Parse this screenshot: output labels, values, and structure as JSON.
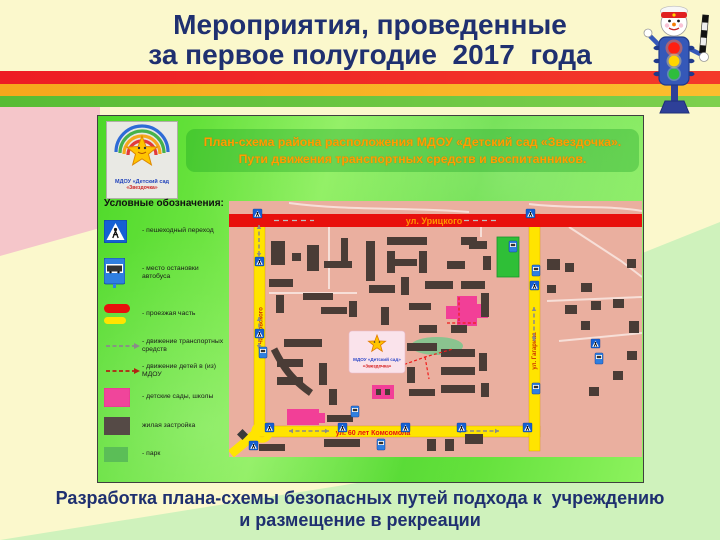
{
  "page": {
    "title": {
      "line1": "Мероприятия, проведенные",
      "line2": "за первое полугодие  2017  года"
    },
    "caption": {
      "line1": "Разработка плана-схемы безопасных путей подхода к  учреждению",
      "line2": "и размещение в рекреации"
    }
  },
  "figure": {
    "logo": {
      "line1": "МДОУ «Детский сад",
      "line2": "«Звездочка»"
    },
    "banner": {
      "line1": "План-схема района расположения МДОУ «Детский сад «Звездочка».",
      "line2": "Пути движения транспортных средств и воспитанников."
    },
    "legend": {
      "title": "Условные обозначения:",
      "items": [
        {
          "name": "crosswalk-sign",
          "label": "- пешеходный переход"
        },
        {
          "name": "bus-stop-sign",
          "label": "- место остановки автобуса"
        },
        {
          "name": "roadway",
          "label": "- проезжая часть"
        },
        {
          "name": "vehicle-traffic",
          "label": "- движение транспортных средств"
        },
        {
          "name": "children-route",
          "label": "- движение детей в (из) МДОУ"
        },
        {
          "name": "kindergartens-schools",
          "label": "- детские сады, школы"
        },
        {
          "name": "residential",
          "label": "жилая застройка"
        },
        {
          "name": "park",
          "label": "- парк"
        }
      ]
    },
    "map": {
      "street_top": "ул. Урицкого",
      "street_bottom": "ул. 60 лет Комсомола",
      "street_left": "ул. Чайковского",
      "street_right": "ул. Гагарина",
      "marker_line1": "МДОУ «Детский сад»",
      "marker_line2": "«Звездочка»",
      "colors": {
        "ground": "#EAAF9F",
        "building": "#4A3C36",
        "street_yellow": "#FFE400",
        "street_red": "#E8100C",
        "pink": "#F23F97",
        "green_zone": "#2FBF37",
        "lawn": "#8AC38F",
        "label_red": "#E81010",
        "label_orange": "#FF9500",
        "path_red": "#F01B1B",
        "arrow_gray": "#8A8A8A"
      },
      "buildings": [
        [
          42,
          40,
          14,
          24
        ],
        [
          63,
          52,
          9,
          8
        ],
        [
          78,
          44,
          12,
          26
        ],
        [
          95,
          60,
          28,
          7
        ],
        [
          112,
          37,
          7,
          26
        ],
        [
          40,
          78,
          24,
          8
        ],
        [
          47,
          94,
          8,
          18
        ],
        [
          74,
          92,
          30,
          7
        ],
        [
          92,
          106,
          26,
          7
        ],
        [
          120,
          100,
          8,
          16
        ],
        [
          137,
          40,
          9,
          40
        ],
        [
          158,
          36,
          40,
          8
        ],
        [
          158,
          50,
          8,
          22
        ],
        [
          190,
          50,
          8,
          22
        ],
        [
          164,
          58,
          24,
          7
        ],
        [
          140,
          84,
          26,
          8
        ],
        [
          172,
          76,
          8,
          18
        ],
        [
          152,
          106,
          8,
          18
        ],
        [
          180,
          102,
          22,
          7
        ],
        [
          196,
          80,
          28,
          8
        ],
        [
          232,
          80,
          24,
          8
        ],
        [
          218,
          60,
          18,
          8
        ],
        [
          240,
          40,
          18,
          8
        ],
        [
          254,
          55,
          8,
          14
        ],
        [
          232,
          36,
          16,
          8
        ],
        [
          252,
          92,
          8,
          24
        ],
        [
          318,
          58,
          13,
          11
        ],
        [
          336,
          62,
          9,
          9
        ],
        [
          352,
          82,
          11,
          9
        ],
        [
          318,
          84,
          9,
          8
        ],
        [
          362,
          100,
          10,
          9
        ],
        [
          384,
          98,
          11,
          9
        ],
        [
          336,
          104,
          12,
          9
        ],
        [
          398,
          58,
          9,
          9
        ],
        [
          352,
          120,
          9,
          9
        ],
        [
          400,
          120,
          10,
          12
        ],
        [
          398,
          150,
          10,
          9
        ],
        [
          384,
          170,
          10,
          9
        ],
        [
          360,
          186,
          10,
          9
        ],
        [
          55,
          138,
          38,
          8
        ],
        [
          48,
          158,
          26,
          8
        ],
        [
          48,
          176,
          26,
          8
        ],
        [
          90,
          162,
          8,
          22
        ],
        [
          100,
          188,
          8,
          16
        ],
        [
          98,
          214,
          26,
          7
        ],
        [
          95,
          238,
          36,
          8
        ],
        [
          198,
          238,
          9,
          12
        ],
        [
          216,
          238,
          9,
          12
        ],
        [
          236,
          233,
          18,
          10
        ],
        [
          30,
          243,
          26,
          7
        ],
        [
          178,
          142,
          30,
          8
        ],
        [
          212,
          148,
          34,
          8
        ],
        [
          212,
          166,
          34,
          8
        ],
        [
          212,
          184,
          34,
          8
        ],
        [
          250,
          152,
          8,
          18
        ],
        [
          252,
          182,
          8,
          14
        ],
        [
          190,
          124,
          18,
          8
        ],
        [
          222,
          124,
          16,
          8
        ],
        [
          178,
          166,
          8,
          16
        ],
        [
          180,
          188,
          26,
          7
        ],
        [
          147,
          188,
          5,
          6
        ],
        [
          156,
          188,
          5,
          6
        ]
      ],
      "pink_buildings": [
        [
          228,
          95,
          20,
          30
        ],
        [
          217,
          105,
          11,
          13
        ],
        [
          248,
          103,
          11,
          14
        ],
        [
          58,
          208,
          32,
          16
        ],
        [
          88,
          212,
          8,
          10
        ],
        [
          143,
          184,
          22,
          14
        ]
      ],
      "green_rect": [
        268,
        36,
        22,
        40
      ],
      "lawn_ellipse": [
        208,
        145,
        26,
        9
      ],
      "curve_row": "M45,148 C54,166 62,178 82,192",
      "diamond": "M13.5,228 L19,233.5 L13.5,239 L8,233.5 Z",
      "crosswalks": [
        [
          24,
          8
        ],
        [
          297,
          8
        ],
        [
          26,
          56
        ],
        [
          26,
          128
        ],
        [
          36,
          222
        ],
        [
          109,
          222
        ],
        [
          172,
          222
        ],
        [
          228,
          222
        ],
        [
          294,
          222
        ],
        [
          301,
          80
        ],
        [
          362,
          138
        ],
        [
          20,
          240
        ]
      ],
      "bus_stops": [
        [
          280,
          40
        ],
        [
          303,
          64
        ],
        [
          303,
          182
        ],
        [
          122,
          205
        ],
        [
          148,
          238
        ],
        [
          30,
          146
        ],
        [
          366,
          152
        ]
      ],
      "red_paths": [
        [
          [
            140,
            160
          ],
          [
            168,
            166
          ],
          [
            196,
            156
          ],
          [
            224,
            148
          ]
        ],
        [
          [
            196,
            156
          ],
          [
            200,
            178
          ]
        ],
        [
          [
            230,
            120
          ],
          [
            230,
            96
          ]
        ],
        [
          [
            218,
            122
          ],
          [
            248,
            122
          ]
        ],
        [
          [
            150,
            132
          ],
          [
            150,
            152
          ]
        ]
      ],
      "gray_arrows": [
        [
          30,
          24,
          30,
          56
        ],
        [
          30,
          116,
          30,
          148
        ],
        [
          60,
          230,
          100,
          230
        ],
        [
          228,
          230,
          270,
          230
        ],
        [
          305,
          106,
          305,
          140
        ]
      ],
      "red_street_dashes": [
        [
          45,
          19.5,
          85,
          19.5
        ],
        [
          235,
          19.5,
          268,
          19.5
        ]
      ],
      "white_paths": [
        "M60,2 C120,10 180,6 240,11",
        "M300,3 C340,8 380,4 413,10",
        "M340,26 L392,60 L413,76",
        "M318,100 L413,96",
        "M330,140 L413,132",
        "M100,14 L100,88",
        "M40,92 L128,92",
        "M252,14 L252,36"
      ]
    }
  }
}
